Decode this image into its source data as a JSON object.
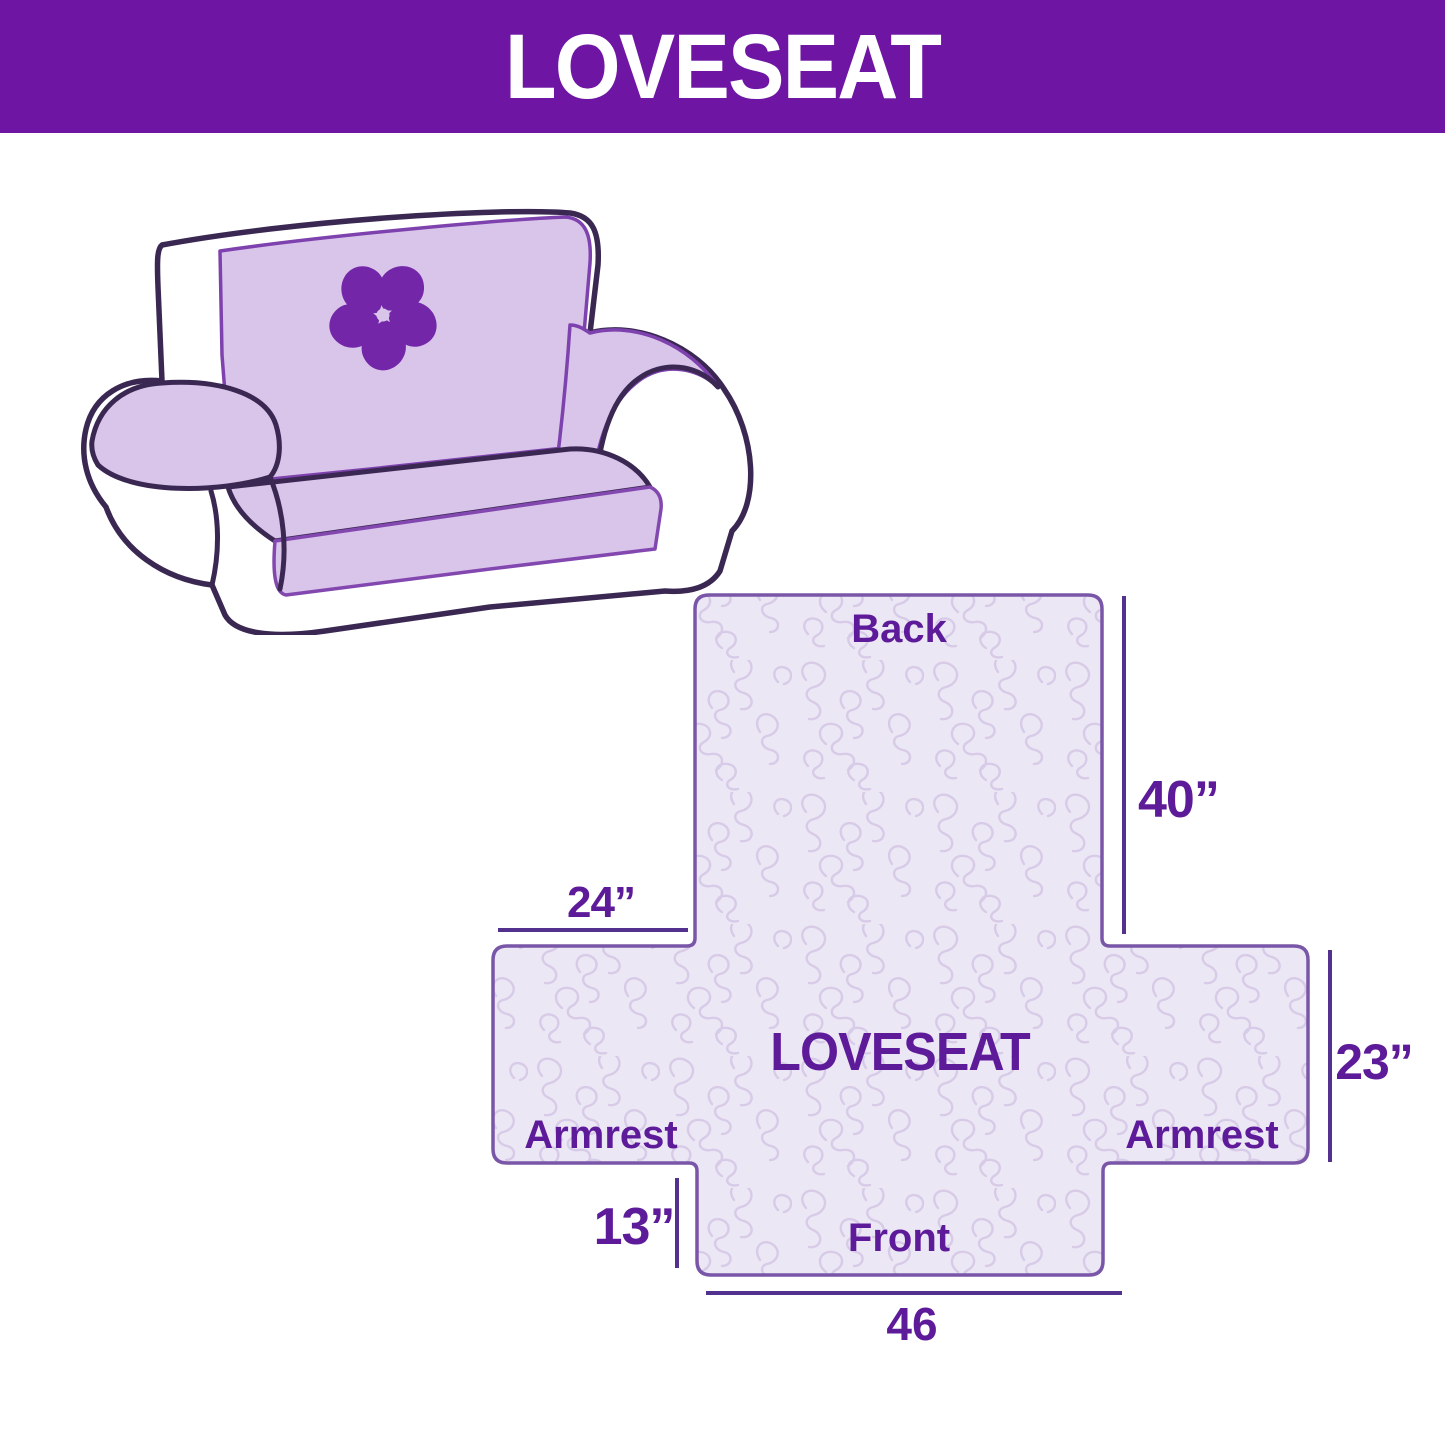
{
  "header": {
    "title": "LOVESEAT",
    "bg_color": "#6e16a3",
    "text_color": "#ffffff"
  },
  "illustration": {
    "subject": "loveseat sofa with quilted furniture cover",
    "cover_color": "#d9c4ea",
    "outline_color": "#3a2853",
    "logo_icon": "pinwheel-flower-icon",
    "logo_color": "#7327a8"
  },
  "diagram": {
    "center_label": "LOVESEAT",
    "back_label": "Back",
    "front_label": "Front",
    "armrest_left_label": "Armrest",
    "armrest_right_label": "Armrest",
    "dims": {
      "back_height": "40”",
      "armrest_top_width": "24”",
      "side_height": "23”",
      "front_flap_height": "13”",
      "front_width": "46"
    },
    "fill_color": "#ece7f5",
    "texture_color": "#d7cbe7",
    "outline_color": "#7a56a8",
    "line_color": "#53318f",
    "text_color": "#5d1b9a"
  }
}
